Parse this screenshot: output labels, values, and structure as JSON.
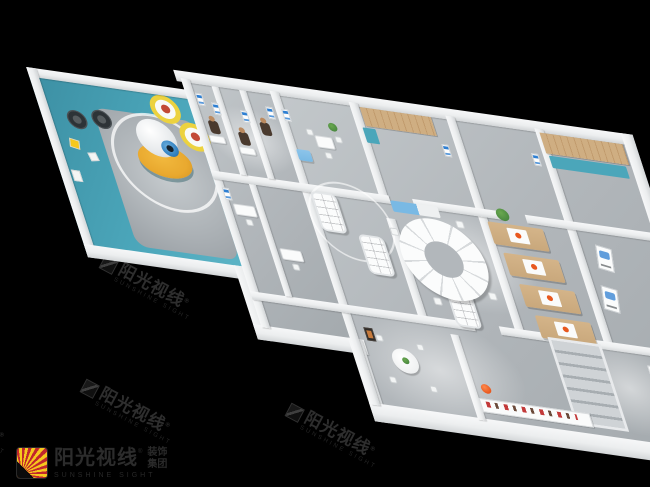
{
  "watermark": {
    "cn": "阳光视线",
    "reg": "®",
    "en": "SUNSHINE SIGHT"
  },
  "logo": {
    "cn": "阳光视线",
    "reg": "®",
    "en": "SUNSHINE SIGHT",
    "suffix_top": "装饰",
    "suffix_bottom": "集团"
  },
  "scene": {
    "type": "3d-floorplan-render",
    "description": "Isometric cutaway 3D render of an eye-care / optical center interior floor plan on a black background",
    "objects": [
      "kids-play-zone",
      "eyeball-sculpture",
      "yellow-display-disc",
      "eye-chart-rings",
      "exam-rooms-with-people",
      "wall-posters",
      "eyewear-display-tables",
      "circular-display-counter",
      "blue-seat-cube",
      "waiting-bench",
      "wood-slat-wall",
      "booth-seating",
      "staircase",
      "consult-round-table",
      "retail-shelf",
      "orange-ball",
      "potted-plants"
    ],
    "colors": {
      "bg": "#000000",
      "teal": "#4ba6ba",
      "teal_dark": "#3c8fa3",
      "floor": "#b2b7bb",
      "floor_dark": "#9aa0a5",
      "wall": "#eceeef",
      "wall_shade": "#d3d6d8",
      "yellow": "#e9a92f",
      "iris": "#2f7fc0",
      "wood": "#c9a87c",
      "poster_blue": "#2e7fd2",
      "blue_seat": "#79b9e4",
      "orange": "#e8581f",
      "plant": "#3e7d3a",
      "logo_red": "#c1272d",
      "logo_yellow": "#f6c81d",
      "wm_ink": "#2e2e2e"
    }
  }
}
